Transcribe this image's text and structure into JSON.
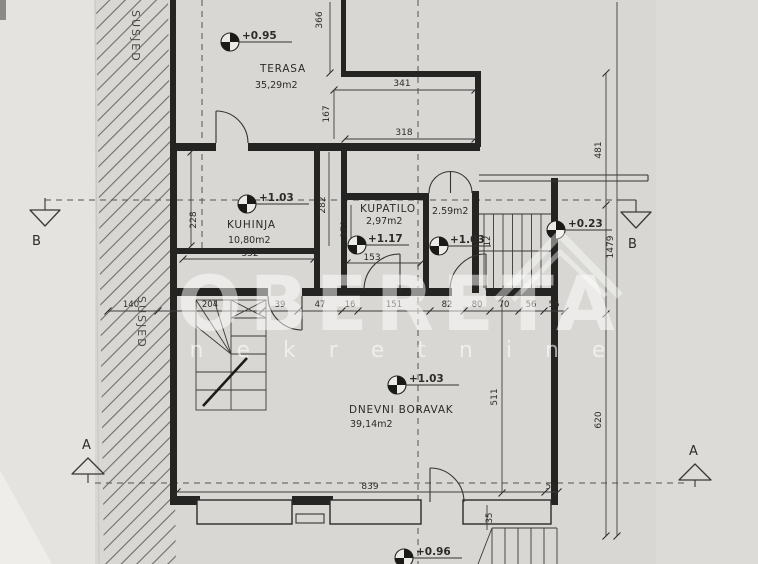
{
  "colors": {
    "paper": "#d8d7d3",
    "ink": "#242422",
    "watermark": "#ffffff"
  },
  "watermark": {
    "brand": "OBERETA",
    "subtitle": "n e k r e t n i n e"
  },
  "boundary": {
    "label": "SUSJED"
  },
  "rooms": {
    "terasa": {
      "name": "TERASA",
      "area": "35,29m2"
    },
    "kuhinja": {
      "name": "KUHINJA",
      "area": "10,80m2"
    },
    "kupatilo": {
      "name": "KUPATILO",
      "area": "2,97m2"
    },
    "predsoblje": {
      "area": "2.59m2"
    },
    "dnevni_boravak": {
      "name": "DNEVNI BORAVAK",
      "area": "39,14m2"
    }
  },
  "levels": {
    "terrace": "+0.95",
    "kitchen": "+1.03",
    "bathroom": "+1.17",
    "hall": "+1.03",
    "entry": "+0.23",
    "living": "+1.03",
    "exterior": "+0.96"
  },
  "sections": {
    "a": "A",
    "b": "B"
  },
  "dims": {
    "t366": "366",
    "t341": "341",
    "t167": "167",
    "t318": "318",
    "r481": "481",
    "r1479": "1479",
    "r620": "620",
    "k228": "228",
    "k282": "282",
    "k352": "352",
    "b170": "170",
    "b153": "153",
    "s12": "12",
    "row": [
      "140",
      "204",
      "39",
      "47",
      "16",
      "151",
      "82",
      "80",
      "70",
      "56",
      "56"
    ],
    "l511": "511",
    "bottom839": "839",
    "bottom56": "56",
    "bottom35": "35"
  }
}
